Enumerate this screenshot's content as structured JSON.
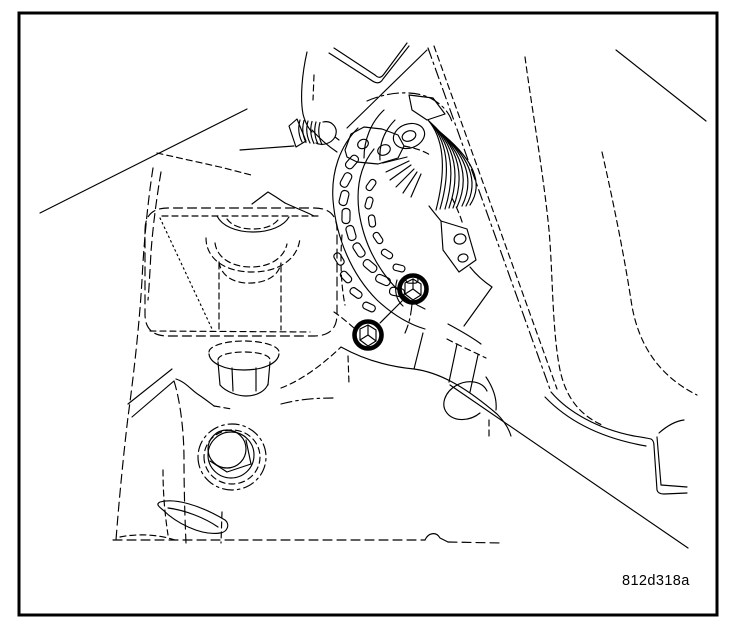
{
  "figure": {
    "code": "812d318a"
  },
  "colors": {
    "line": "#000000",
    "background": "#ffffff",
    "frame": "#000000",
    "highlight_ring": "#000000"
  }
}
